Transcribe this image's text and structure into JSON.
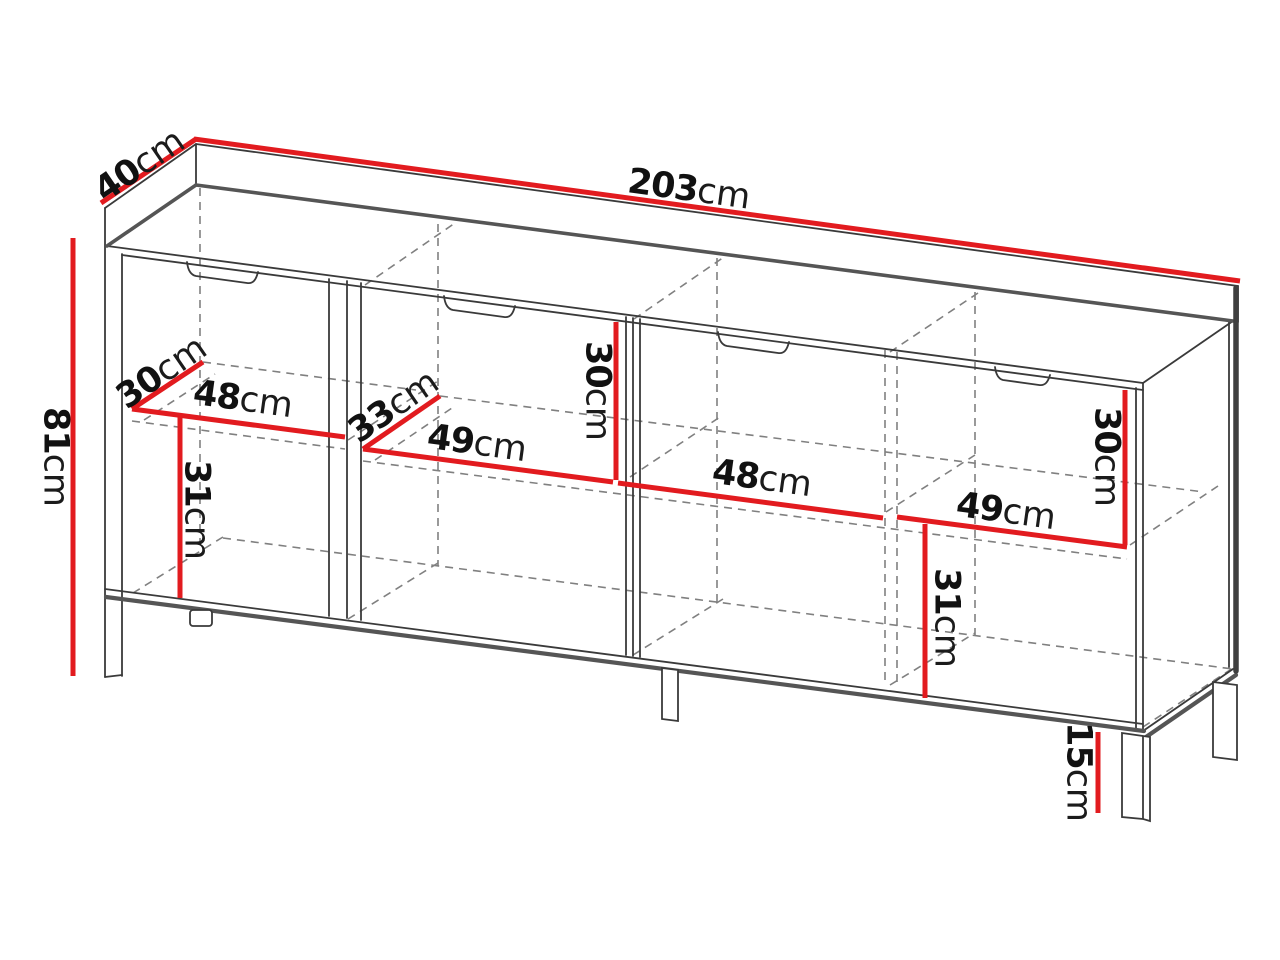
{
  "diagram": {
    "type": "furniture-dimension-drawing",
    "subject": "four-door sideboard with metal legs",
    "unit": "cm",
    "accent_color": "#e21b1f",
    "outline_color": "#3a3a3a",
    "shadow_color": "#555555",
    "hidden_line_color": "#808080",
    "dimensions": {
      "width": {
        "value": "203",
        "unit": "cm"
      },
      "depth": {
        "value": "40",
        "unit": "cm"
      },
      "height": {
        "value": "81",
        "unit": "cm"
      },
      "shelf_depth_left": {
        "value": "30",
        "unit": "cm"
      },
      "section1_width": {
        "value": "48",
        "unit": "cm"
      },
      "shelf_depth_mid": {
        "value": "33",
        "unit": "cm"
      },
      "section2_width": {
        "value": "49",
        "unit": "cm"
      },
      "upper_center_height": {
        "value": "30",
        "unit": "cm"
      },
      "section3_width": {
        "value": "48",
        "unit": "cm"
      },
      "section4_width": {
        "value": "49",
        "unit": "cm"
      },
      "upper_right_height": {
        "value": "30",
        "unit": "cm"
      },
      "lower_left_height": {
        "value": "31",
        "unit": "cm"
      },
      "lower_right_height": {
        "value": "31",
        "unit": "cm"
      },
      "leg_height": {
        "value": "15",
        "unit": "cm"
      }
    }
  }
}
